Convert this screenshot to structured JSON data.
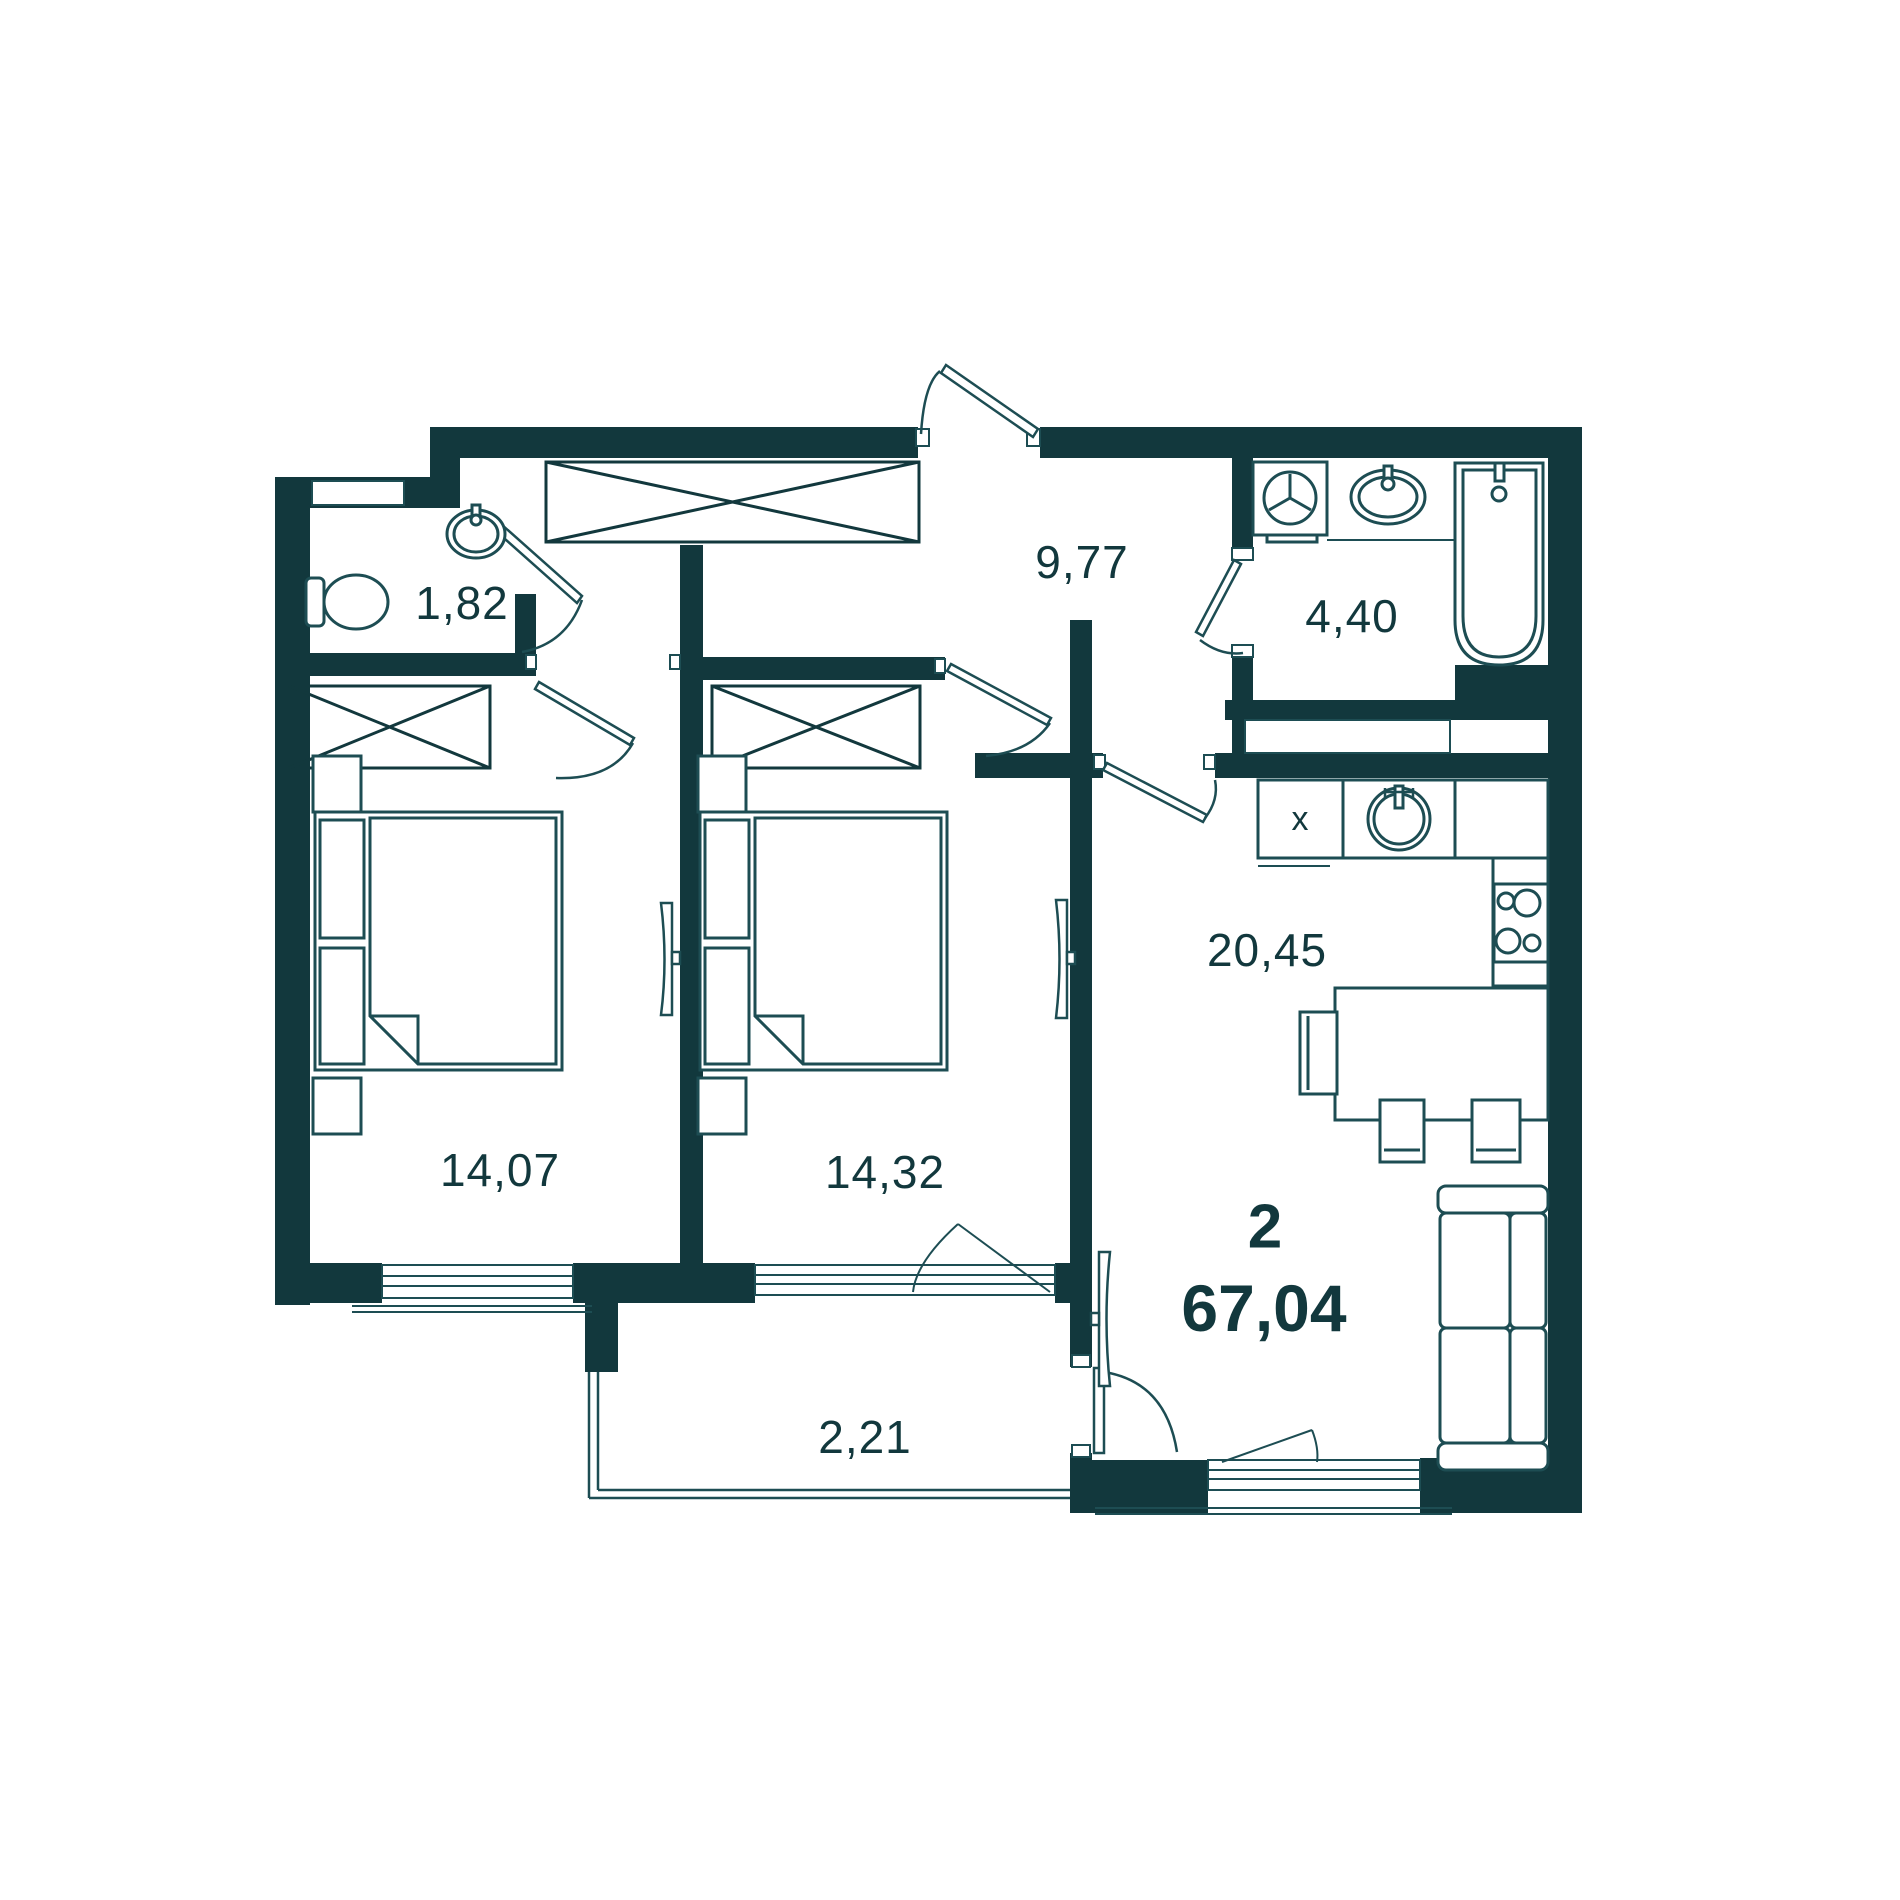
{
  "plan": {
    "title": "apartment-floor-plan",
    "summary": {
      "rooms_count": "2",
      "total_area": "67,04"
    },
    "rooms": [
      {
        "id": "wc",
        "area": "1,82"
      },
      {
        "id": "hallway",
        "area": "9,77"
      },
      {
        "id": "bathroom",
        "area": "4,40"
      },
      {
        "id": "bedroom-1",
        "area": "14,07"
      },
      {
        "id": "bedroom-2",
        "area": "14,32"
      },
      {
        "id": "kitchen-living",
        "area": "20,45"
      },
      {
        "id": "balcony",
        "area": "2,21"
      }
    ],
    "kitchen_cabinet_mark": "x",
    "colors": {
      "wall": "#12383d",
      "line": "#1d4d53",
      "background": "#ffffff"
    }
  }
}
